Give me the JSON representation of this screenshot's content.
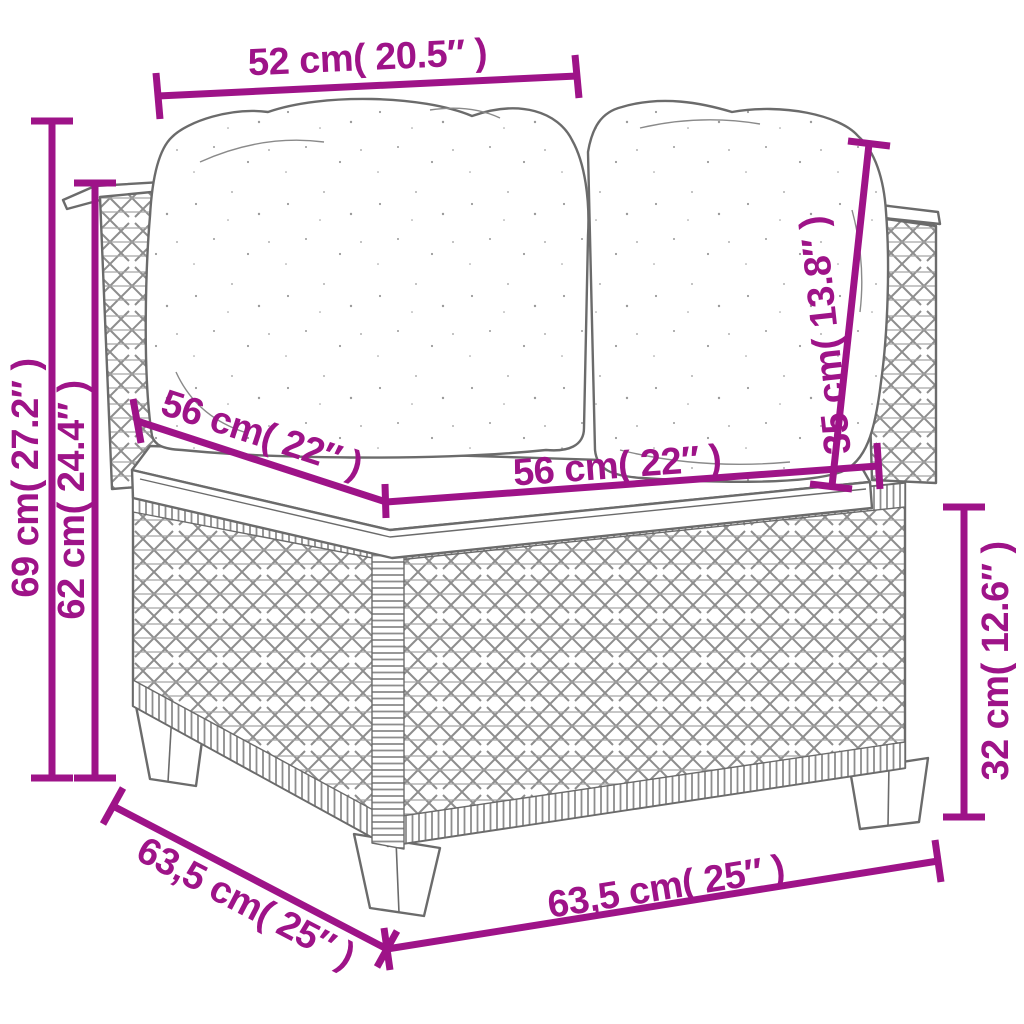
{
  "diagram_title": "corner-sofa-with-cushions-dimension-diagram",
  "colors": {
    "accent": "#9E1388",
    "drawing_line": "#6b6b6b",
    "background": "#ffffff"
  },
  "dimensions": {
    "top_back_width": {
      "label": "52 cm( 20.5″ )",
      "cm": "52",
      "inch": "20.5"
    },
    "total_height": {
      "label": "69 cm( 27.2″ )",
      "cm": "69",
      "inch": "27.2"
    },
    "back_height": {
      "label": "62 cm( 24.4″ )",
      "cm": "62",
      "inch": "24.4"
    },
    "seat_depth": {
      "label": "56 cm( 22″ )",
      "cm": "56",
      "inch": "22"
    },
    "seat_width": {
      "label": "56 cm( 22″ )",
      "cm": "56",
      "inch": "22"
    },
    "back_cushion_height": {
      "label": "35 cm( 13.8″ )",
      "cm": "35",
      "inch": "13.8"
    },
    "base_height": {
      "label": "32 cm( 12.6″ )",
      "cm": "32",
      "inch": "12.6"
    },
    "total_depth": {
      "label": "63,5 cm( 25″ )",
      "cm": "63,5",
      "inch": "25"
    },
    "total_width": {
      "label": "63,5 cm( 25″ )",
      "cm": "63,5",
      "inch": "25"
    }
  }
}
